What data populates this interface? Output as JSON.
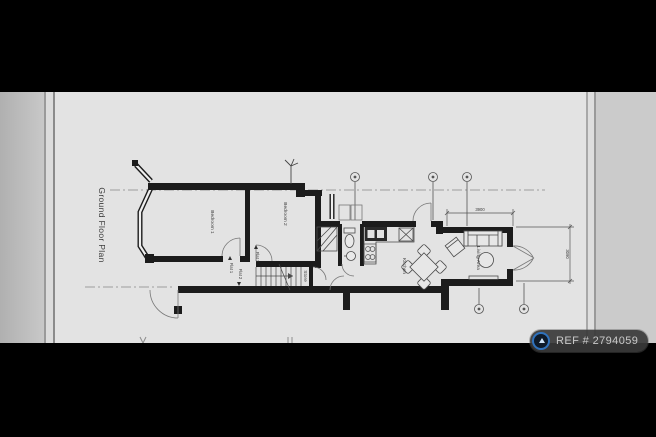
{
  "title": {
    "text": "Ground Floor Plan"
  },
  "watermark": {
    "ref": "REF # 2794059",
    "logo_icon": "house-logo-icon"
  },
  "rooms": {
    "bedroom1": "Bedroom 1",
    "bedroom2": "Bedroom 2",
    "kitchen": "Kitchen",
    "living_area": "Living Area",
    "store": "Store",
    "flat1_upper": "Flat 1",
    "flat1_hall": "Flat 1",
    "flat2_hall": "Flat 2"
  },
  "dimensions": {
    "living_width": "3900",
    "living_depth": "3090"
  },
  "icons": {
    "grid_bubble": "grid-bubble-icon",
    "vent": "flue-vent-icon"
  },
  "colors": {
    "page_bg": "#e3e3e3",
    "band": "#000000",
    "wall": "#1c1c1c",
    "thin_line": "#555555",
    "centerline": "#888888",
    "watermark_bg": "#3a3a3a",
    "watermark_text": "#c9c9c9",
    "logo_blue": "#2f72bd"
  }
}
